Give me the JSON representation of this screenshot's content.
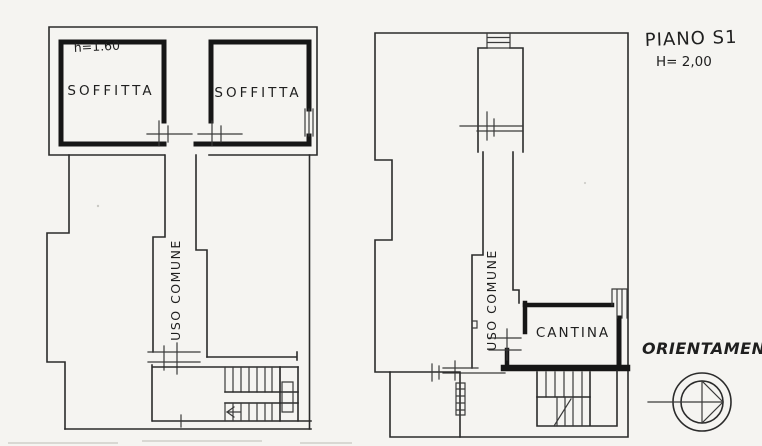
{
  "page": {
    "background_color": "#f5f4f1",
    "ink_color": "#2b2b2b",
    "wall_color": "#161616"
  },
  "left_plan": {
    "attic_height_label": "h=1.60",
    "room_left_label": "SOFFITTA",
    "room_right_label": "SOFFITTA",
    "corridor_label": "USO COMUNE"
  },
  "right_plan": {
    "title": "PIANO S1",
    "height_label": "H= 2,00",
    "corridor_label": "USO COMUNE",
    "cellar_label": "CANTINA"
  },
  "orientation": {
    "label": "ORIENTAMENTO",
    "compass_icon": "compass-rose"
  }
}
